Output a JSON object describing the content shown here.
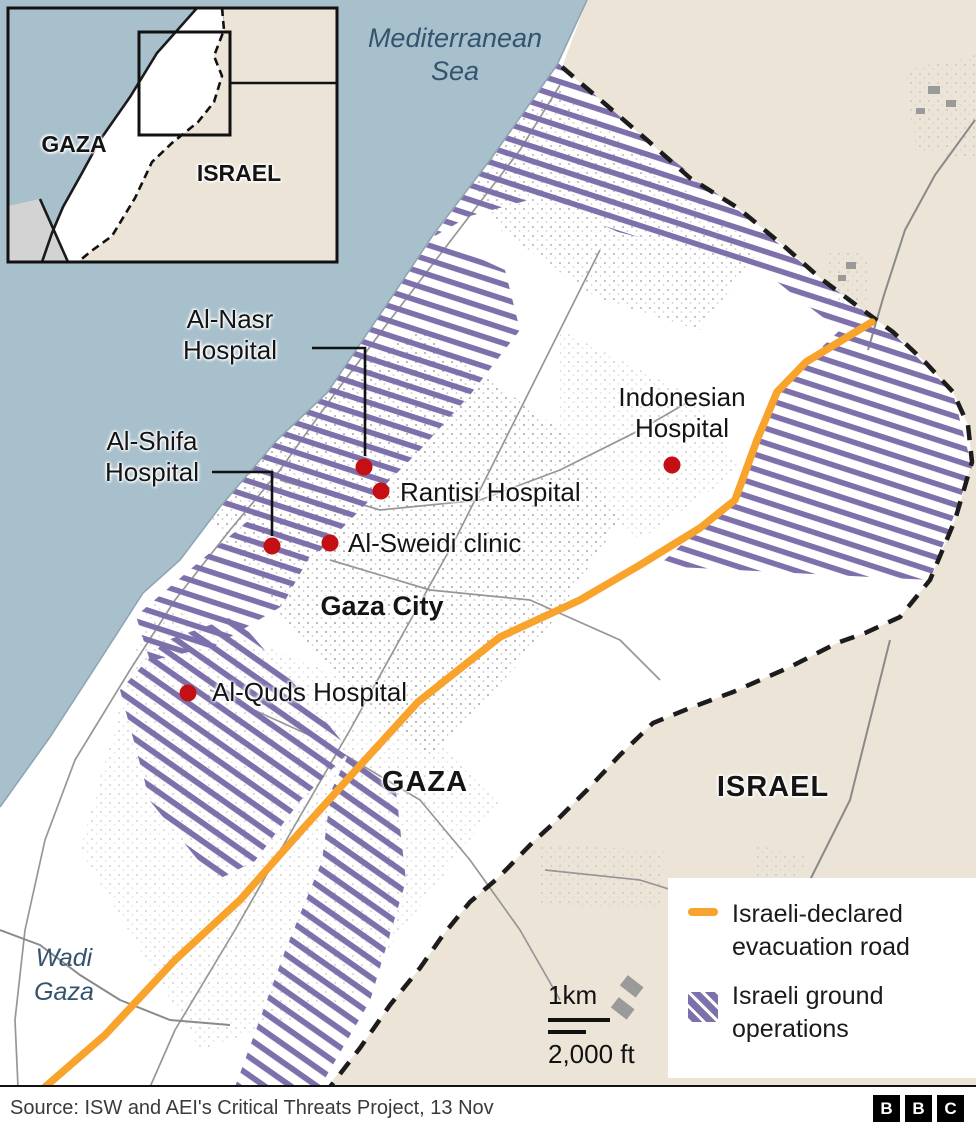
{
  "inset": {
    "gaza_label": "GAZA",
    "israel_label": "ISRAEL"
  },
  "sea_label": {
    "line1": "Mediterranean",
    "line2": "Sea"
  },
  "places": {
    "gaza_city": "Gaza City",
    "gaza": "GAZA",
    "israel": "ISRAEL",
    "wadi_line1": "Wadi",
    "wadi_line2": "Gaza"
  },
  "hospitals": {
    "al_nasr": {
      "line1": "Al-Nasr",
      "line2": "Hospital"
    },
    "al_shifa": {
      "line1": "Al-Shifa",
      "line2": "Hospital"
    },
    "rantisi": {
      "label": "Rantisi Hospital"
    },
    "al_sweidi": {
      "label": "Al-Sweidi clinic"
    },
    "indonesian": {
      "line1": "Indonesian",
      "line2": "Hospital"
    },
    "al_quds": {
      "label": "Al-Quds Hospital"
    }
  },
  "legend": {
    "road_line1": "Israeli-declared",
    "road_line2": "evacuation road",
    "ground_line1": "Israeli ground",
    "ground_line2": "operations"
  },
  "scale": {
    "km": "1km",
    "ft": "2,000 ft"
  },
  "source": {
    "text": "Source: ISW and AEI's Critical Threats Project, 13 Nov"
  },
  "bbc_logo": {
    "b1": "B",
    "b2": "B",
    "b3": "C"
  },
  "colors": {
    "sea": "#a7c0cc",
    "israel": "#ece4d7",
    "hatch": "#7e70ab",
    "road": "#f8a32c",
    "marker": "#c40f14",
    "border": "#1c1c1c",
    "sealabel": "#33536e",
    "text": "#141414"
  }
}
